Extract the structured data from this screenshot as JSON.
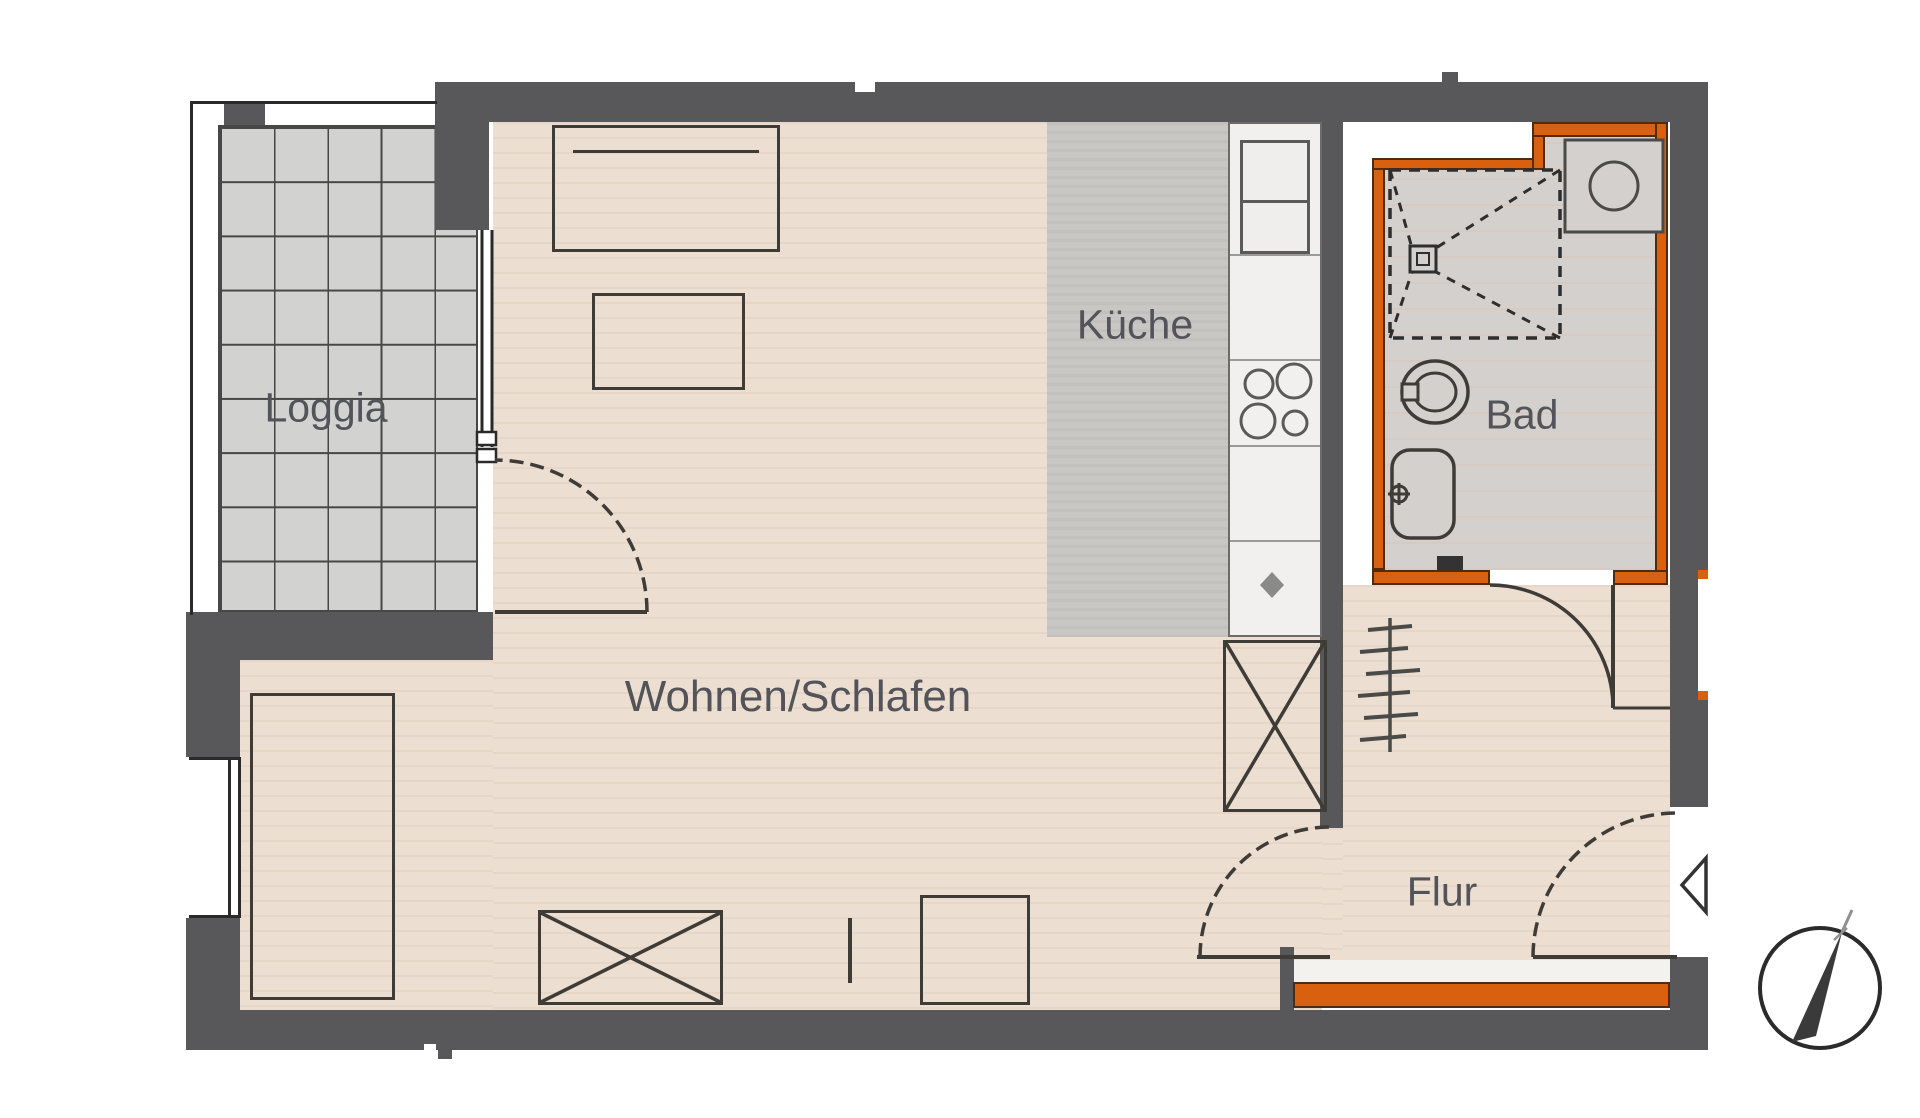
{
  "plan": {
    "type": "apartment-floorplan",
    "rooms": [
      {
        "id": "loggia",
        "label": "Loggia"
      },
      {
        "id": "wohnen",
        "label": "Wohnen/Schlafen"
      },
      {
        "id": "kueche",
        "label": "Küche"
      },
      {
        "id": "bad",
        "label": "Bad"
      },
      {
        "id": "flur",
        "label": "Flur"
      }
    ],
    "symbols": {
      "north_arrow": "compass-circle-with-needle",
      "entrance": "triangle-pointing-left",
      "shower": "dashed-square-with-drain",
      "washing_machine": "square-with-circle",
      "wardrobe": "rect-with-x",
      "coat_rack": "line-with-ticks",
      "stove": "four-burner-circles",
      "dishwasher": "diamond"
    },
    "colors": {
      "wall": "#58585a",
      "highlight_wall": "#d9600f",
      "wood_floor": "#ecdfd2",
      "loggia_tile": "#d2d2d0",
      "kitchen_floor": "#c9c7c4",
      "bath_floor": "#d3d0cd",
      "linework": "#3f3b36",
      "label_text": "#53535a"
    }
  }
}
